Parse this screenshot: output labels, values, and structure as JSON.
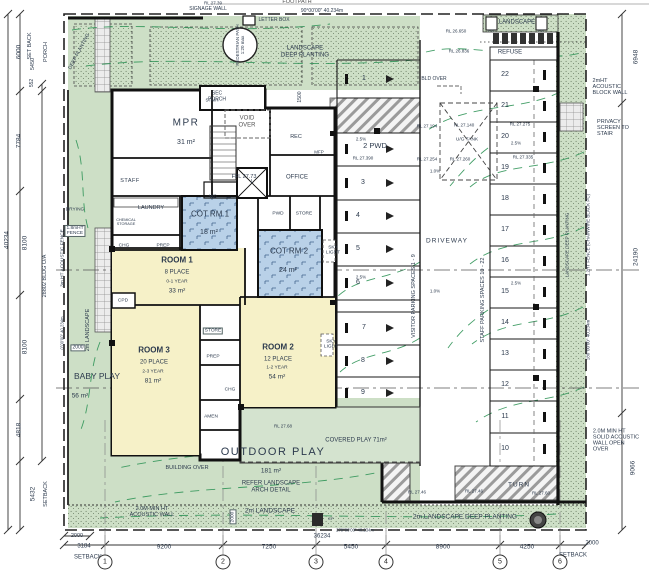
{
  "colors": {
    "landscape_green": "#cddfc6",
    "covered_play_green": "#d4e3cf",
    "room_yellow": "#f6f1c8",
    "cot_blue": "#b9d1e8",
    "wall_black": "#141618",
    "contour_green": "#2f9457",
    "hatch_gray": "#9b9b9b",
    "text_dark": "#2c3a4d"
  },
  "grid_bubbles": [
    {
      "label": "1",
      "x": 105,
      "y": 562
    },
    {
      "label": "2",
      "x": 223,
      "y": 562
    },
    {
      "label": "3",
      "x": 316,
      "y": 562
    },
    {
      "label": "4",
      "x": 386,
      "y": 562
    },
    {
      "label": "5",
      "x": 500,
      "y": 562
    },
    {
      "label": "6",
      "x": 560,
      "y": 562
    }
  ],
  "labels": [
    {
      "n": "rl-top-label",
      "t": "RL 27.39",
      "x": 213,
      "y": 3,
      "fs": 4.5
    },
    {
      "n": "footpath-label",
      "t": "FOOTPATH",
      "x": 297,
      "y": 2,
      "fs": 5.5,
      "c": "#555"
    },
    {
      "n": "boundary-bearing-top",
      "t": "90°00'00\" 40.234m",
      "x": 322,
      "y": 12,
      "fs": 5
    },
    {
      "n": "signage-wall-label",
      "t": "SIGNAGE WALL",
      "x": 208,
      "y": 10,
      "fs": 5
    },
    {
      "n": "letter-box-label",
      "t": "LETTER BOX",
      "x": 274,
      "y": 21,
      "fs": 5
    },
    {
      "n": "pedestrian-path-label",
      "t": "PEDESTRIAN PATH\n1:20 max",
      "x": 240,
      "y": 45,
      "fs": 4.5,
      "rot": -90
    },
    {
      "n": "landscape-deep-planting-top-label",
      "t": "LANDSCAPE\nDEEP PLANTING",
      "x": 305,
      "y": 52,
      "fs": 6
    },
    {
      "n": "deep-planting-left-label",
      "t": "DEEP PLANTING",
      "x": 80,
      "y": 52,
      "fs": 5,
      "rot": -62
    },
    {
      "n": "sec-porch-label",
      "t": "SEC\nPORCH",
      "x": 217,
      "y": 97,
      "fs": 5
    },
    {
      "n": "dim-1500",
      "t": "1500",
      "x": 301,
      "y": 97,
      "fs": 5,
      "rot": -90
    },
    {
      "n": "stair-label",
      "t": "STAIR",
      "x": 212,
      "y": 100,
      "fs": 4.5
    },
    {
      "n": "void-over-label",
      "t": "VOID\nOVER",
      "x": 247,
      "y": 122,
      "fs": 6,
      "c": "#555"
    },
    {
      "n": "rec-label",
      "t": "REC",
      "x": 296,
      "y": 137,
      "fs": 5.5
    },
    {
      "n": "mfp-label",
      "t": "MFP",
      "x": 319,
      "y": 152,
      "fs": 4.5
    },
    {
      "n": "ffl-label",
      "t": "FFL 27.73",
      "x": 244,
      "y": 177,
      "fs": 5.5
    },
    {
      "n": "office-label",
      "t": "OFFICE",
      "x": 297,
      "y": 178,
      "fs": 6
    },
    {
      "n": "mpr-label",
      "t": "MPR",
      "x": 186,
      "y": 123,
      "fs": 10,
      "ls": 1.5
    },
    {
      "n": "mpr-area",
      "t": "31 m²",
      "x": 186,
      "y": 143,
      "fs": 7
    },
    {
      "n": "staff-room-label",
      "t": "STAFF",
      "x": 130,
      "y": 181,
      "fs": 5.5,
      "ls": 0.5
    },
    {
      "n": "wc-label",
      "t": "WC",
      "x": 213,
      "y": 196,
      "fs": 4.5
    },
    {
      "n": "lift-label",
      "t": "L",
      "x": 252,
      "y": 183,
      "fs": 5
    },
    {
      "n": "laundry-label",
      "t": "LAUNDRY",
      "x": 151,
      "y": 208,
      "fs": 5.5
    },
    {
      "n": "chemical-storage-label",
      "t": "CHEMICAL\nSTORAGE",
      "x": 126,
      "y": 222,
      "fs": 3.8
    },
    {
      "n": "chg-1-label",
      "t": "CHG",
      "x": 124,
      "y": 246,
      "fs": 4.8
    },
    {
      "n": "prep-1-label",
      "t": "PREP",
      "x": 163,
      "y": 246,
      "fs": 4.8
    },
    {
      "n": "cot-rm1-label",
      "t": "COT RM 1",
      "x": 210,
      "y": 215,
      "fs": 8
    },
    {
      "n": "cot-rm1-area",
      "t": "18 m²",
      "x": 209,
      "y": 233,
      "fs": 7
    },
    {
      "n": "room1-label",
      "t": "ROOM 1",
      "x": 177,
      "y": 261,
      "fs": 8,
      "b": 1
    },
    {
      "n": "room1-place",
      "t": "8 PLACE",
      "x": 177,
      "y": 273,
      "fs": 6
    },
    {
      "n": "room1-age",
      "t": "0-1 YEAR",
      "x": 177,
      "y": 282,
      "fs": 4.8
    },
    {
      "n": "room1-area",
      "t": "33 m²",
      "x": 177,
      "y": 291,
      "fs": 6.5
    },
    {
      "n": "cpd-label",
      "t": "CPD",
      "x": 123,
      "y": 301,
      "fs": 4.8
    },
    {
      "n": "pwd-label",
      "t": "PWD",
      "x": 278,
      "y": 214,
      "fs": 4.8
    },
    {
      "n": "store-1-label",
      "t": "STORE",
      "x": 304,
      "y": 214,
      "fs": 4.8
    },
    {
      "n": "cot-rm2-label",
      "t": "COT RM 2",
      "x": 289,
      "y": 252,
      "fs": 8
    },
    {
      "n": "cot-rm2-area",
      "t": "24 m²",
      "x": 288,
      "y": 271,
      "fs": 7
    },
    {
      "n": "skylight-1-label",
      "t": "SKY\nLIGHT",
      "x": 333,
      "y": 251,
      "fs": 4.8
    },
    {
      "n": "skylight-2-label",
      "t": "SKY\nLIGHT",
      "x": 331,
      "y": 345,
      "fs": 4.8
    },
    {
      "n": "room3-label",
      "t": "ROOM 3",
      "x": 154,
      "y": 351,
      "fs": 8,
      "b": 1
    },
    {
      "n": "room3-place",
      "t": "20 PLACE",
      "x": 154,
      "y": 363,
      "fs": 6
    },
    {
      "n": "room3-age",
      "t": "2-3 YEAR",
      "x": 153,
      "y": 372,
      "fs": 4.8
    },
    {
      "n": "room3-area",
      "t": "81 m²",
      "x": 153,
      "y": 381,
      "fs": 6.5
    },
    {
      "n": "room2-label",
      "t": "ROOM 2",
      "x": 278,
      "y": 348,
      "fs": 8,
      "b": 1
    },
    {
      "n": "room2-place",
      "t": "12 PLACE",
      "x": 278,
      "y": 360,
      "fs": 6
    },
    {
      "n": "room2-age",
      "t": "1-2 YEAR",
      "x": 277,
      "y": 368,
      "fs": 4.8
    },
    {
      "n": "room2-area",
      "t": "54 m²",
      "x": 277,
      "y": 377,
      "fs": 6.5
    },
    {
      "n": "store-2-label",
      "t": "STORE",
      "x": 213,
      "y": 331,
      "fs": 4.8,
      "box": 1
    },
    {
      "n": "prep-2-label",
      "t": "PREP",
      "x": 213,
      "y": 357,
      "fs": 4.8
    },
    {
      "n": "chg-2-label",
      "t": "CHG",
      "x": 230,
      "y": 390,
      "fs": 4.8
    },
    {
      "n": "amen-label",
      "t": "AMEN",
      "x": 211,
      "y": 417,
      "fs": 4.8
    },
    {
      "n": "baby-play-label",
      "t": "BABY PLAY",
      "x": 97,
      "y": 377,
      "fs": 8.5
    },
    {
      "n": "baby-play-area",
      "t": "56 m²",
      "x": 80,
      "y": 396,
      "fs": 6.5
    },
    {
      "n": "landscape-2m-left-label",
      "t": "2m LANDSCAPE",
      "x": 88,
      "y": 330,
      "fs": 5.5,
      "rot": -90
    },
    {
      "n": "dim-2000-baby",
      "t": "2000",
      "x": 78,
      "y": 348,
      "fs": 5,
      "box": 1
    },
    {
      "n": "boundary-bearing-left",
      "t": "0°00'00\" 40.234m",
      "x": 63,
      "y": 333,
      "fs": 4.2,
      "rot": -90
    },
    {
      "n": "drying-label",
      "t": "DRYING",
      "x": 75,
      "y": 210,
      "fs": 4.8
    },
    {
      "n": "fence-18-label",
      "t": "1.8mHT\nFENCE",
      "x": 75,
      "y": 231,
      "fs": 4.8,
      "box": 1
    },
    {
      "n": "fence-3m-label",
      "t": "3m HT ACOUSTIC FENCE",
      "x": 63,
      "y": 258,
      "fs": 4.8,
      "rot": -90
    },
    {
      "n": "outdoor-rl",
      "t": "RL 27.68",
      "x": 283,
      "y": 426,
      "fs": 4.5
    },
    {
      "n": "outdoor-play-label",
      "t": "OUTDOOR PLAY",
      "x": 273,
      "y": 452,
      "fs": 11,
      "ls": 1.5
    },
    {
      "n": "outdoor-area",
      "t": "181 m²",
      "x": 271,
      "y": 471,
      "fs": 6.5
    },
    {
      "n": "outdoor-refer",
      "t": "REFER LANDSCAPE\nARCH DETAIL",
      "x": 271,
      "y": 487,
      "fs": 6
    },
    {
      "n": "covered-play-label",
      "t": "COVERED PLAY 71m²",
      "x": 356,
      "y": 441,
      "fs": 6
    },
    {
      "n": "building-over-label",
      "t": "BUILDING OVER",
      "x": 187,
      "y": 468,
      "fs": 5.5
    },
    {
      "n": "landscape-2m-bottom-label",
      "t": "2m LANDSCAPE",
      "x": 270,
      "y": 511,
      "fs": 6.5
    },
    {
      "n": "dim-2000-bottom",
      "t": "2000",
      "x": 233,
      "y": 517,
      "fs": 4.8,
      "rot": -90,
      "box": 1
    },
    {
      "n": "acoustic-wall-bottom-label",
      "t": "2.0M MIN HT\nACOUSTIC WALL",
      "x": 152,
      "y": 512,
      "fs": 5.5
    },
    {
      "n": "ep-label",
      "t": "EP",
      "x": 331,
      "y": 519,
      "fs": 4
    },
    {
      "n": "landscape-deep-bottom-label",
      "t": "2m LANDSCAPE DEEP PLANTING",
      "x": 465,
      "y": 517,
      "fs": 6.5
    },
    {
      "n": "driveway-label",
      "t": "DRIVEWAY",
      "x": 447,
      "y": 241,
      "fs": 6.5,
      "ls": 1
    },
    {
      "n": "visitor-parking-label",
      "t": "VISITOR PARKING SPACES 1 - 9",
      "x": 414,
      "y": 296,
      "fs": 5.5,
      "rot": -90
    },
    {
      "n": "staff-parking-label",
      "t": "STAFF PARKING SPACES 10 - 22",
      "x": 483,
      "y": 300,
      "fs": 5.5,
      "rot": -90
    },
    {
      "n": "ug-tank-label",
      "t": "U/G TANK",
      "x": 467,
      "y": 140,
      "fs": 4.8
    },
    {
      "n": "bld-over-label",
      "t": "BLD OVER",
      "x": 434,
      "y": 80,
      "fs": 5
    },
    {
      "n": "turn-label",
      "t": "TURN",
      "x": 519,
      "y": 485,
      "fs": 6.5,
      "ls": 1
    },
    {
      "n": "rl-2746-a",
      "t": "RL 27.46",
      "x": 417,
      "y": 492,
      "fs": 4.5
    },
    {
      "n": "rl-2746-b",
      "t": "RL 27.46",
      "x": 474,
      "y": 491,
      "fs": 4.5
    },
    {
      "n": "rl-2760",
      "t": "RL 27.60",
      "x": 541,
      "y": 493,
      "fs": 4.5
    },
    {
      "n": "visitor-space-1",
      "t": "1",
      "x": 364,
      "y": 79,
      "fs": 7
    },
    {
      "n": "visitor-space-2-pwd",
      "t": "2 PWD",
      "x": 375,
      "y": 146,
      "fs": 7.5
    },
    {
      "n": "visitor-space-3",
      "t": "3",
      "x": 363,
      "y": 183,
      "fs": 7
    },
    {
      "n": "visitor-space-4",
      "t": "4",
      "x": 358,
      "y": 216,
      "fs": 7
    },
    {
      "n": "visitor-space-5",
      "t": "5",
      "x": 358,
      "y": 249,
      "fs": 7
    },
    {
      "n": "visitor-space-6",
      "t": "6",
      "x": 358,
      "y": 283,
      "fs": 7
    },
    {
      "n": "visitor-space-7",
      "t": "7",
      "x": 364,
      "y": 328,
      "fs": 7
    },
    {
      "n": "visitor-space-8",
      "t": "8",
      "x": 363,
      "y": 361,
      "fs": 7
    },
    {
      "n": "visitor-space-9",
      "t": "9",
      "x": 363,
      "y": 393,
      "fs": 7
    },
    {
      "n": "staff-space-22",
      "t": "22",
      "x": 505,
      "y": 75,
      "fs": 7
    },
    {
      "n": "staff-space-21",
      "t": "21",
      "x": 505,
      "y": 106,
      "fs": 7
    },
    {
      "n": "staff-space-20",
      "t": "20",
      "x": 505,
      "y": 137,
      "fs": 7
    },
    {
      "n": "staff-space-19",
      "t": "19",
      "x": 505,
      "y": 168,
      "fs": 7
    },
    {
      "n": "staff-space-18",
      "t": "18",
      "x": 505,
      "y": 199,
      "fs": 7
    },
    {
      "n": "staff-space-17",
      "t": "17",
      "x": 505,
      "y": 230,
      "fs": 7
    },
    {
      "n": "staff-space-16",
      "t": "16",
      "x": 505,
      "y": 261,
      "fs": 7
    },
    {
      "n": "staff-space-15",
      "t": "15",
      "x": 505,
      "y": 292,
      "fs": 7
    },
    {
      "n": "staff-space-14",
      "t": "14",
      "x": 505,
      "y": 323,
      "fs": 7
    },
    {
      "n": "staff-space-13",
      "t": "13",
      "x": 505,
      "y": 354,
      "fs": 7
    },
    {
      "n": "staff-space-12",
      "t": "12",
      "x": 505,
      "y": 385,
      "fs": 7
    },
    {
      "n": "staff-space-11",
      "t": "11",
      "x": 505,
      "y": 417,
      "fs": 7
    },
    {
      "n": "staff-space-10",
      "t": "10",
      "x": 505,
      "y": 449,
      "fs": 7
    },
    {
      "n": "slope-25-a",
      "t": "2.5%",
      "x": 361,
      "y": 139,
      "fs": 4.5
    },
    {
      "n": "slope-25-b",
      "t": "2.5%",
      "x": 516,
      "y": 143,
      "fs": 4.5
    },
    {
      "n": "slope-25-c",
      "t": "2.5%",
      "x": 361,
      "y": 277,
      "fs": 4.5
    },
    {
      "n": "slope-25-d",
      "t": "2.5%",
      "x": 516,
      "y": 283,
      "fs": 4.5
    },
    {
      "n": "slope-10-a",
      "t": "1.0%",
      "x": 435,
      "y": 171,
      "fs": 4.5
    },
    {
      "n": "slope-10-b",
      "t": "1.0%",
      "x": 435,
      "y": 291,
      "fs": 4.5
    },
    {
      "n": "rl-26650",
      "t": "RL 26.650",
      "x": 456,
      "y": 31,
      "fs": 4.5
    },
    {
      "n": "rl-26836",
      "t": "RL 26.836",
      "x": 459,
      "y": 51,
      "fs": 4.5
    },
    {
      "n": "rl-27194",
      "t": "RL 27.194",
      "x": 427,
      "y": 126,
      "fs": 4.5
    },
    {
      "n": "rl-27140",
      "t": "RL 27.140",
      "x": 464,
      "y": 125,
      "fs": 4.5
    },
    {
      "n": "rl-27275",
      "t": "RL 27.275",
      "x": 520,
      "y": 124,
      "fs": 4.5
    },
    {
      "n": "rl-27390",
      "t": "RL 27.390",
      "x": 363,
      "y": 158,
      "fs": 4.5
    },
    {
      "n": "rl-27254",
      "t": "RL 27.254",
      "x": 427,
      "y": 159,
      "fs": 4.5
    },
    {
      "n": "rl-27260",
      "t": "RL 27.260",
      "x": 460,
      "y": 159,
      "fs": 4.5
    },
    {
      "n": "rl-27335",
      "t": "RL 27.335",
      "x": 523,
      "y": 157,
      "fs": 4.5
    },
    {
      "n": "refuse-label",
      "t": "REFUSE",
      "x": 510,
      "y": 53,
      "fs": 6
    },
    {
      "n": "landscape-top-right-label",
      "t": "LANDSCAPE",
      "x": 517,
      "y": 23,
      "fs": 6
    },
    {
      "n": "fg-1-label",
      "t": "FG",
      "x": 491,
      "y": 31,
      "fs": 4
    },
    {
      "n": "fg-2-label",
      "t": "FG",
      "x": 541,
      "y": 31,
      "fs": 4
    },
    {
      "n": "acoustic-block-wall-label",
      "t": "2mHT\nACOUSTIC\nBLOCK WALL",
      "x": 610,
      "y": 87,
      "fs": 5.5,
      "al": "left"
    },
    {
      "n": "privacy-screen-label",
      "t": "PRIVACY\nSCREEN TO\nSTAIR",
      "x": 613,
      "y": 128,
      "fs": 5.5,
      "al": "left"
    },
    {
      "n": "solid-acoustic-wall-label",
      "t": "2.0M MIN HT\nSOLID ACOUSTIC\nWALL OPEN\nOVER",
      "x": 616,
      "y": 441,
      "fs": 5.5,
      "al": "left"
    },
    {
      "n": "fence-12-label",
      "t": "1.2HT FENCE (CHAINWIRE BLACK PC)",
      "x": 588,
      "y": 235,
      "fs": 4.5,
      "rot": -90
    },
    {
      "n": "boundary-bearing-right",
      "t": "180°00'00\" 40.234m",
      "x": 588,
      "y": 340,
      "fs": 4.5,
      "rot": -90
    },
    {
      "n": "landscape-deep-right-label",
      "t": "LANDSCAPE DEEP PLANTING",
      "x": 567,
      "y": 245,
      "fs": 4.5,
      "rot": -90
    },
    {
      "n": "dim-40234",
      "t": "40234",
      "x": 7,
      "y": 240,
      "fs": 6.5,
      "rot": -90
    },
    {
      "n": "dim-6000",
      "t": "6000",
      "x": 19,
      "y": 52,
      "fs": 6.5,
      "rot": -90
    },
    {
      "n": "dim-setback-top",
      "t": "SET BACK",
      "x": 30,
      "y": 46,
      "fs": 5.5,
      "rot": -90
    },
    {
      "n": "dim-5450-left",
      "t": "5450",
      "x": 33,
      "y": 64,
      "fs": 5.5,
      "rot": -90
    },
    {
      "n": "dim-porch",
      "t": "PORCH",
      "x": 46,
      "y": 52,
      "fs": 5.5,
      "rot": -90
    },
    {
      "n": "dim-552",
      "t": "552",
      "x": 33,
      "y": 83,
      "fs": 5,
      "rot": -90
    },
    {
      "n": "dim-7784",
      "t": "7784",
      "x": 19,
      "y": 141,
      "fs": 6.5,
      "rot": -90
    },
    {
      "n": "dim-8100-a",
      "t": "8100",
      "x": 25,
      "y": 243,
      "fs": 6.5,
      "rot": -90
    },
    {
      "n": "dim-28802-bldg",
      "t": "28802 BLDG O/A",
      "x": 45,
      "y": 276,
      "fs": 5.5,
      "rot": -90
    },
    {
      "n": "dim-8100-b",
      "t": "8100",
      "x": 25,
      "y": 347,
      "fs": 6.5,
      "rot": -90
    },
    {
      "n": "dim-4818",
      "t": "4818",
      "x": 19,
      "y": 430,
      "fs": 6.5,
      "rot": -90
    },
    {
      "n": "dim-5432",
      "t": "5432",
      "x": 33,
      "y": 494,
      "fs": 6.5,
      "rot": -90
    },
    {
      "n": "dim-setback-bottom-left-v",
      "t": "SETBACK",
      "x": 46,
      "y": 494,
      "fs": 5.5,
      "rot": -90
    },
    {
      "n": "dim-6948",
      "t": "6948",
      "x": 636,
      "y": 57,
      "fs": 6.5,
      "rot": -90
    },
    {
      "n": "dim-24190",
      "t": "24190",
      "x": 636,
      "y": 257,
      "fs": 6.5,
      "rot": -90
    },
    {
      "n": "dim-9066",
      "t": "9066",
      "x": 633,
      "y": 468,
      "fs": 6.5,
      "rot": -90
    },
    {
      "n": "dim-2000-bottom-left",
      "t": "2000",
      "x": 77,
      "y": 536,
      "fs": 5.5
    },
    {
      "n": "dim-3184",
      "t": "3184",
      "x": 84,
      "y": 547,
      "fs": 6
    },
    {
      "n": "dim-9200",
      "t": "9200",
      "x": 164,
      "y": 547,
      "fs": 6.5
    },
    {
      "n": "dim-7250",
      "t": "7250",
      "x": 269,
      "y": 547,
      "fs": 6.5
    },
    {
      "n": "dim-5450-bottom",
      "t": "5450",
      "x": 351,
      "y": 547,
      "fs": 6.5
    },
    {
      "n": "dim-8900",
      "t": "8900",
      "x": 443,
      "y": 547,
      "fs": 6.5
    },
    {
      "n": "dim-4250",
      "t": "4250",
      "x": 527,
      "y": 547,
      "fs": 6.5
    },
    {
      "n": "dim-2000-bottom-right",
      "t": "2000",
      "x": 592,
      "y": 544,
      "fs": 6
    },
    {
      "n": "setback-bottom-left",
      "t": "SETBACK",
      "x": 88,
      "y": 558,
      "fs": 6
    },
    {
      "n": "setback-bottom-right",
      "t": "SETBACK",
      "x": 573,
      "y": 556,
      "fs": 6
    },
    {
      "n": "dim-36234",
      "t": "36234",
      "x": 322,
      "y": 537,
      "fs": 6
    },
    {
      "n": "boundary-bearing-bottom",
      "t": "270°00'00\" 40.234m",
      "x": 355,
      "y": 531,
      "fs": 4.2
    }
  ]
}
